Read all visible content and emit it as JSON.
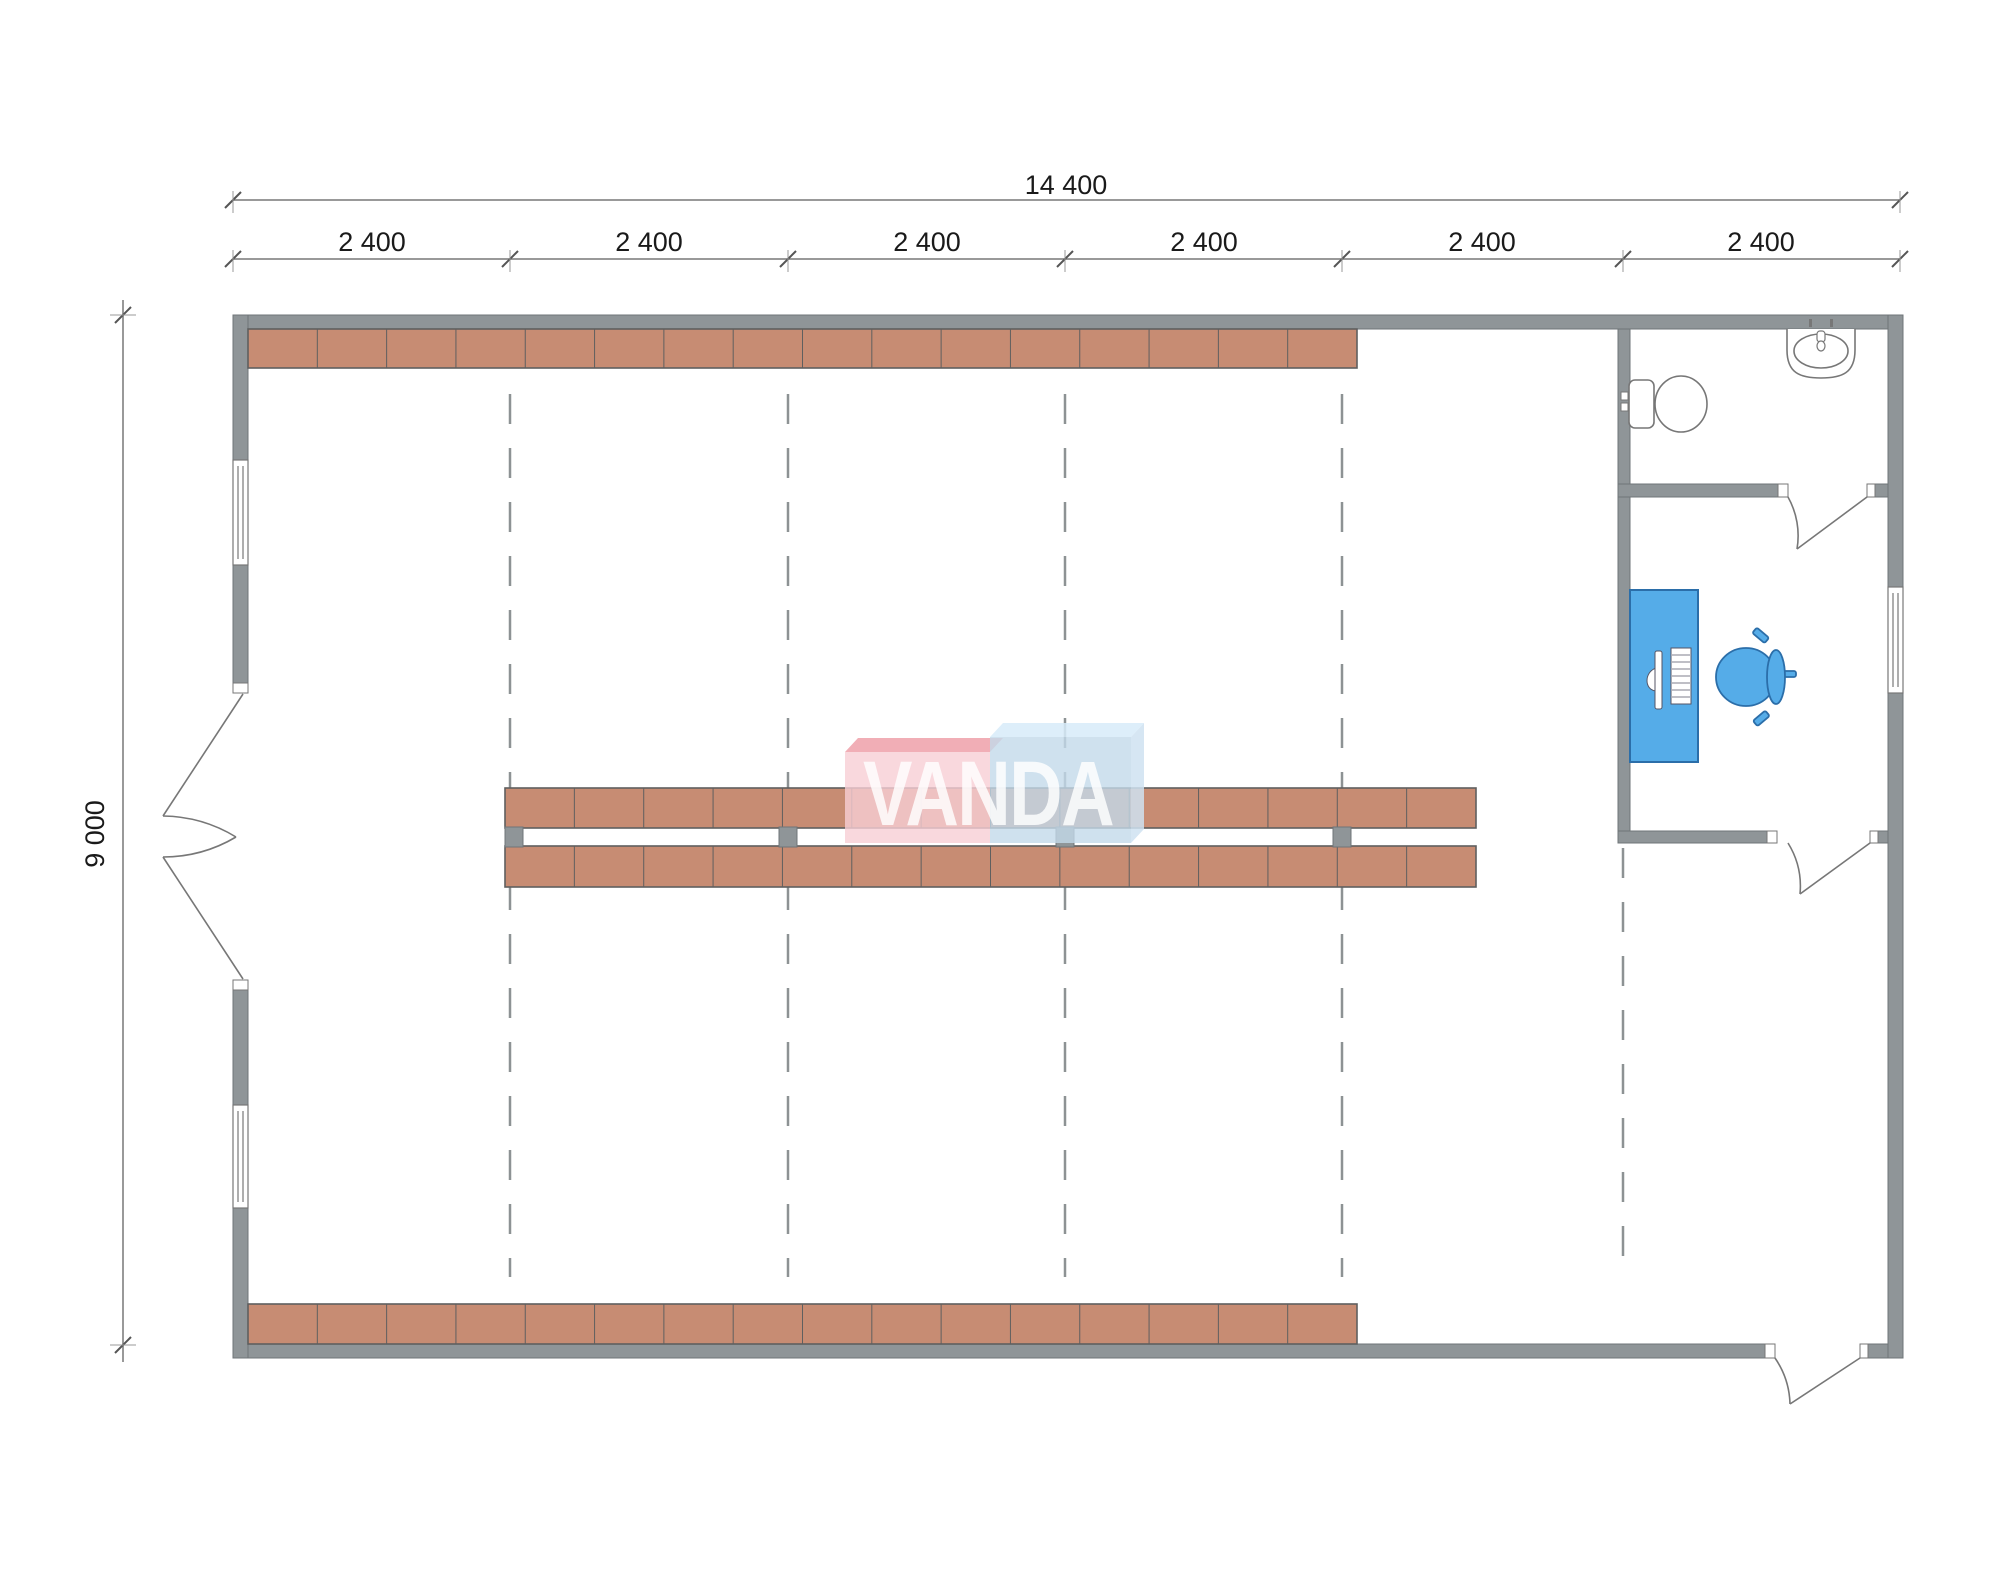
{
  "title": "Warehouse floor plan with shelving, bathroom and office",
  "dimensions": {
    "total_width_label": "14 400",
    "height_label": "9 000",
    "segment_labels": [
      "2 400",
      "2 400",
      "2 400",
      "2 400",
      "2 400",
      "2 400"
    ]
  },
  "watermark": {
    "text": "VANDA"
  },
  "plan": {
    "building_width_mm": 14400,
    "building_height_mm": 9000,
    "grid_bay_mm": 2400,
    "grid_bays": 6,
    "rooms": [
      "main-hall",
      "bathroom",
      "office"
    ],
    "fixtures": [
      "toilet",
      "sink",
      "desk",
      "monitor",
      "keyboard",
      "office-chair"
    ],
    "doors": [
      "double-entry-door-left",
      "bathroom-door",
      "office-door",
      "exit-door-bottom-right"
    ],
    "windows": [
      "left-window-upper",
      "left-window-lower",
      "office-window-right"
    ],
    "shelving": {
      "top_wall_row_units": 16,
      "bottom_wall_row_units": 16,
      "center_island_rows": 2,
      "center_island_units_per_row": 14,
      "center_island_posts": 4
    }
  },
  "colors": {
    "wall": "#8f9598",
    "wall_edge": "#6f7578",
    "shelf": "#c78c73",
    "shelf_edge": "#5f5f5f",
    "fixture_line": "#777777",
    "furniture_blue": "#55ace8",
    "furniture_blue_edge": "#2b6ea9",
    "dash_line": "#8d9294",
    "dimension_line": "#999999",
    "dimension_tick": "#555555",
    "watermark_pink_top": "#ee9aa4",
    "watermark_pink_front": "#f7ced4",
    "watermark_blue_top": "#d7ebf9",
    "watermark_blue_front": "#c3d9ea",
    "watermark_blue_side": "#cfe2f1"
  }
}
